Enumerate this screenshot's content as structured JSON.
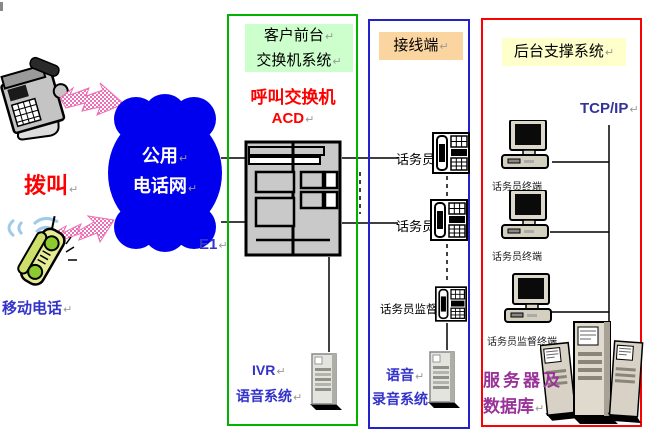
{
  "caller": {
    "dial_label": "拨叫",
    "mobile_label": "移动电话",
    "cloud_line1": "公用",
    "cloud_line2": "电话网",
    "e1_label": "E1"
  },
  "front_office": {
    "header_line1": "客户前台",
    "header_line2": "交换机系统",
    "acd_line1": "呼叫交换机",
    "acd_line2": "ACD",
    "ivr_line1": "IVR",
    "ivr_line2": "语音系统"
  },
  "line_terminal": {
    "header": "接线端",
    "operators": [
      {
        "label": "话务员"
      },
      {
        "label": "话务员"
      },
      {
        "label": "话务员监督"
      }
    ],
    "recorder_line1": "语音",
    "recorder_line2": "录音系统"
  },
  "backend": {
    "header": "后台支撑系统",
    "protocol_label": "TCP/IP",
    "terminals": [
      {
        "label": "话务员终端"
      },
      {
        "label": "话务员终端"
      },
      {
        "label": "话务员监督终端"
      }
    ],
    "server_line1": "服务器及",
    "server_line2": "数据库"
  },
  "marks": {
    "para": "↵"
  },
  "colors": {
    "cloud_blue": "#0000EE",
    "green_border": "#00B300",
    "blue_border": "#2222CC",
    "red_border": "#FF0000",
    "green_header_bg": "#CCFFCC",
    "orange_header_bg": "#FBD5A0",
    "yellow_header_bg": "#FFFFCC",
    "red_text": "#FF0000",
    "blue_text": "#3333CC",
    "purple_text": "#993399",
    "pink_arrow": "#F06EB4"
  }
}
